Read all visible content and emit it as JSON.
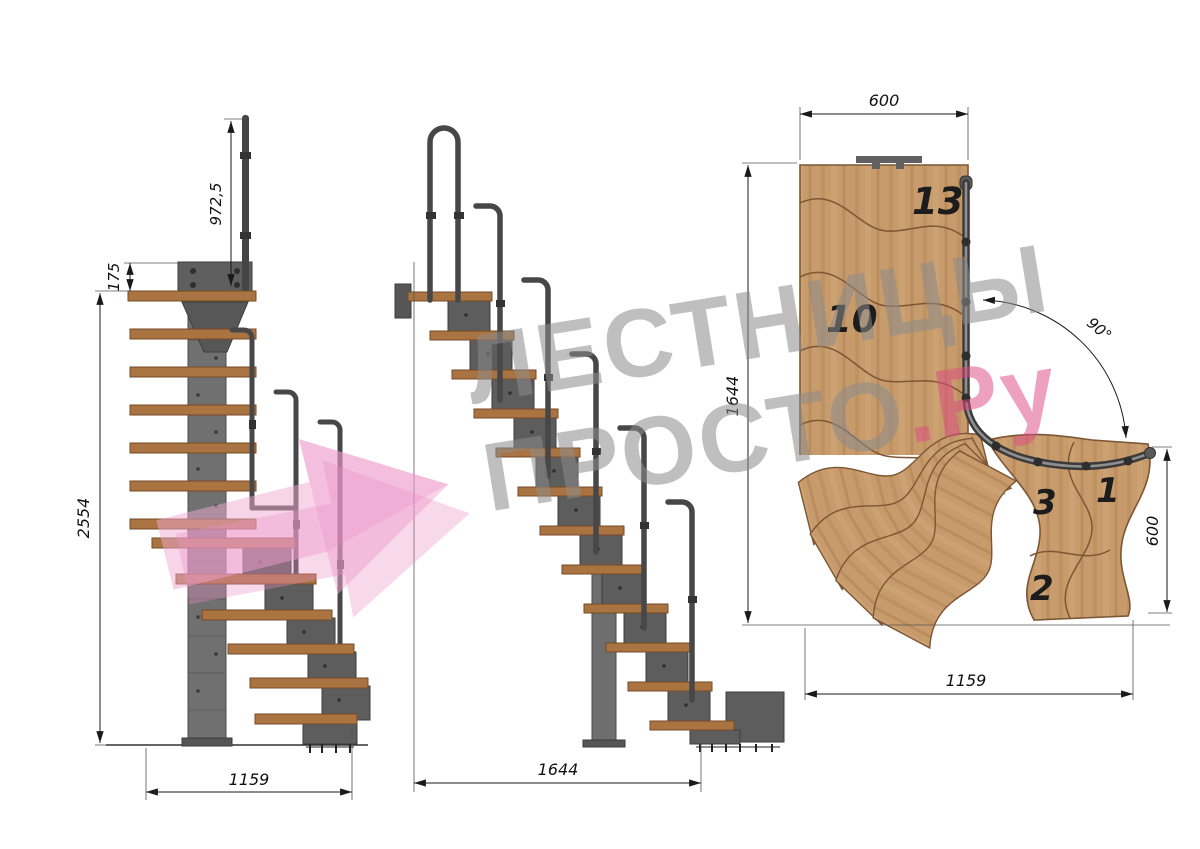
{
  "views": {
    "front": {
      "dim_rail_height": "972,5",
      "dim_plate_offset": "175",
      "dim_total_height": "2554",
      "dim_width": "1159"
    },
    "side": {
      "dim_length": "1644"
    },
    "plan": {
      "dim_top_width": "600",
      "dim_side_length": "1644",
      "dim_angle": "90°",
      "dim_right_depth": "600",
      "dim_bottom_length": "1159",
      "steps": {
        "s13": "13",
        "s10": "10",
        "s3": "3",
        "s1": "1",
        "s2": "2"
      }
    }
  },
  "watermark": {
    "line1": "ЛЕСТНИЦЫ",
    "line2": "ПРОСТО",
    "suffix": ".Ру"
  },
  "colors": {
    "wood_plan": "#c79b6c",
    "wood_grain": "#ad7c4c",
    "wood_tread": "#aa7442",
    "steel": "#707070",
    "steel_dark": "#474747",
    "dim_line": "#1a1a1a",
    "watermark_gray": "#8c8c8c",
    "watermark_pink": "#dd4b82",
    "arrow_pink": "#f1a9d2"
  }
}
